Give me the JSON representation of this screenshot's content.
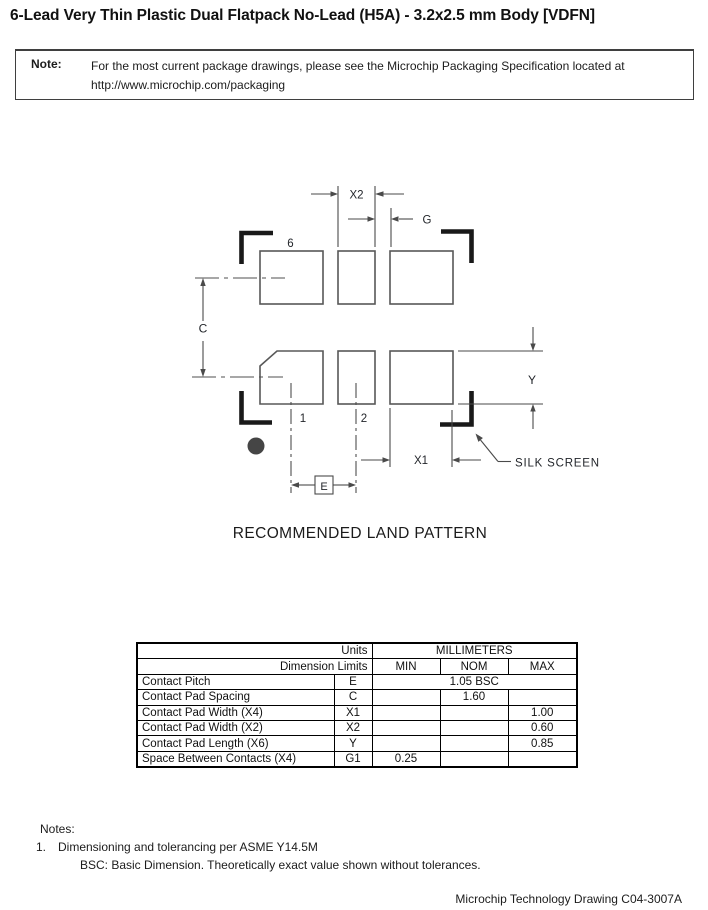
{
  "page": {
    "title": "6-Lead Very Thin Plastic Dual Flatpack No-Lead (H5A) - 3.2x2.5 mm Body [VDFN]",
    "footer_right": "Microchip Technology Drawing C04-3007A"
  },
  "note_box": {
    "label": "Note:",
    "line1": "For the most current package drawings, please see the Microchip Packaging Specification located at",
    "line2": "http://www.microchip.com/packaging"
  },
  "diagram": {
    "caption": "RECOMMENDED LAND PATTERN",
    "silk_screen_label": "SILK SCREEN",
    "labels": {
      "x2": "X2",
      "g": "G",
      "c": "C",
      "y": "Y",
      "x1": "X1",
      "e": "E"
    },
    "pin_numbers": {
      "pin6": "6",
      "pin1": "1",
      "pin2": "2"
    },
    "colors": {
      "pad_outline": "#585858",
      "dimension_line": "#4a4a4a",
      "silk_mark": "#191919",
      "pin1_dot": "#454545"
    }
  },
  "table": {
    "units_label": "Units",
    "units_value": "MILLIMETERS",
    "dimension_limits_label": "Dimension Limits",
    "columns": {
      "min": "MIN",
      "nom": "NOM",
      "max": "MAX"
    },
    "rows": [
      {
        "name": "Contact Pitch",
        "symbol": "E",
        "value": "1.05 BSC"
      },
      {
        "name": "Contact Pad Spacing",
        "symbol": "C",
        "min": "",
        "nom": "1.60",
        "max": ""
      },
      {
        "name": "Contact Pad Width (X4)",
        "symbol": "X1",
        "min": "",
        "nom": "",
        "max": "1.00"
      },
      {
        "name": "Contact Pad Width (X2)",
        "symbol": "X2",
        "min": "",
        "nom": "",
        "max": "0.60"
      },
      {
        "name": "Contact Pad Length (X6)",
        "symbol": "Y",
        "min": "",
        "nom": "",
        "max": "0.85"
      },
      {
        "name": "Space Between Contacts (X4)",
        "symbol": "G1",
        "min": "0.25",
        "nom": "",
        "max": ""
      }
    ]
  },
  "notes": {
    "heading": "Notes:",
    "item1_number": "1.",
    "item1_text": "Dimensioning and tolerancing per ASME Y14.5M",
    "item1_sub": "BSC: Basic Dimension. Theoretically exact value shown without tolerances."
  }
}
